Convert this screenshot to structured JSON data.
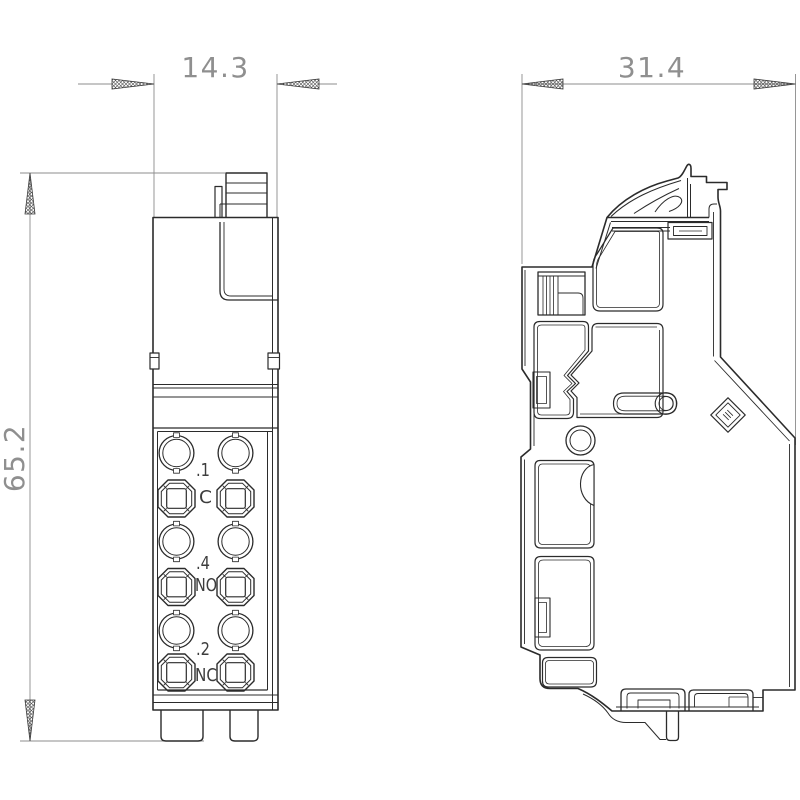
{
  "drawing": {
    "title": "terminal-module-dimension-drawing",
    "background": "#ffffff",
    "line_color": "#2b2b2b",
    "dim_color": "#8c8c8c",
    "dimensions": {
      "front_width": "14.3",
      "front_height": "65.2",
      "side_depth": "31.4"
    },
    "front_view": {
      "terminals": [
        {
          "num": ".1",
          "fn": "C"
        },
        {
          "num": ".4",
          "fn": "NO"
        },
        {
          "num": ".2",
          "fn": "NC"
        }
      ]
    }
  }
}
